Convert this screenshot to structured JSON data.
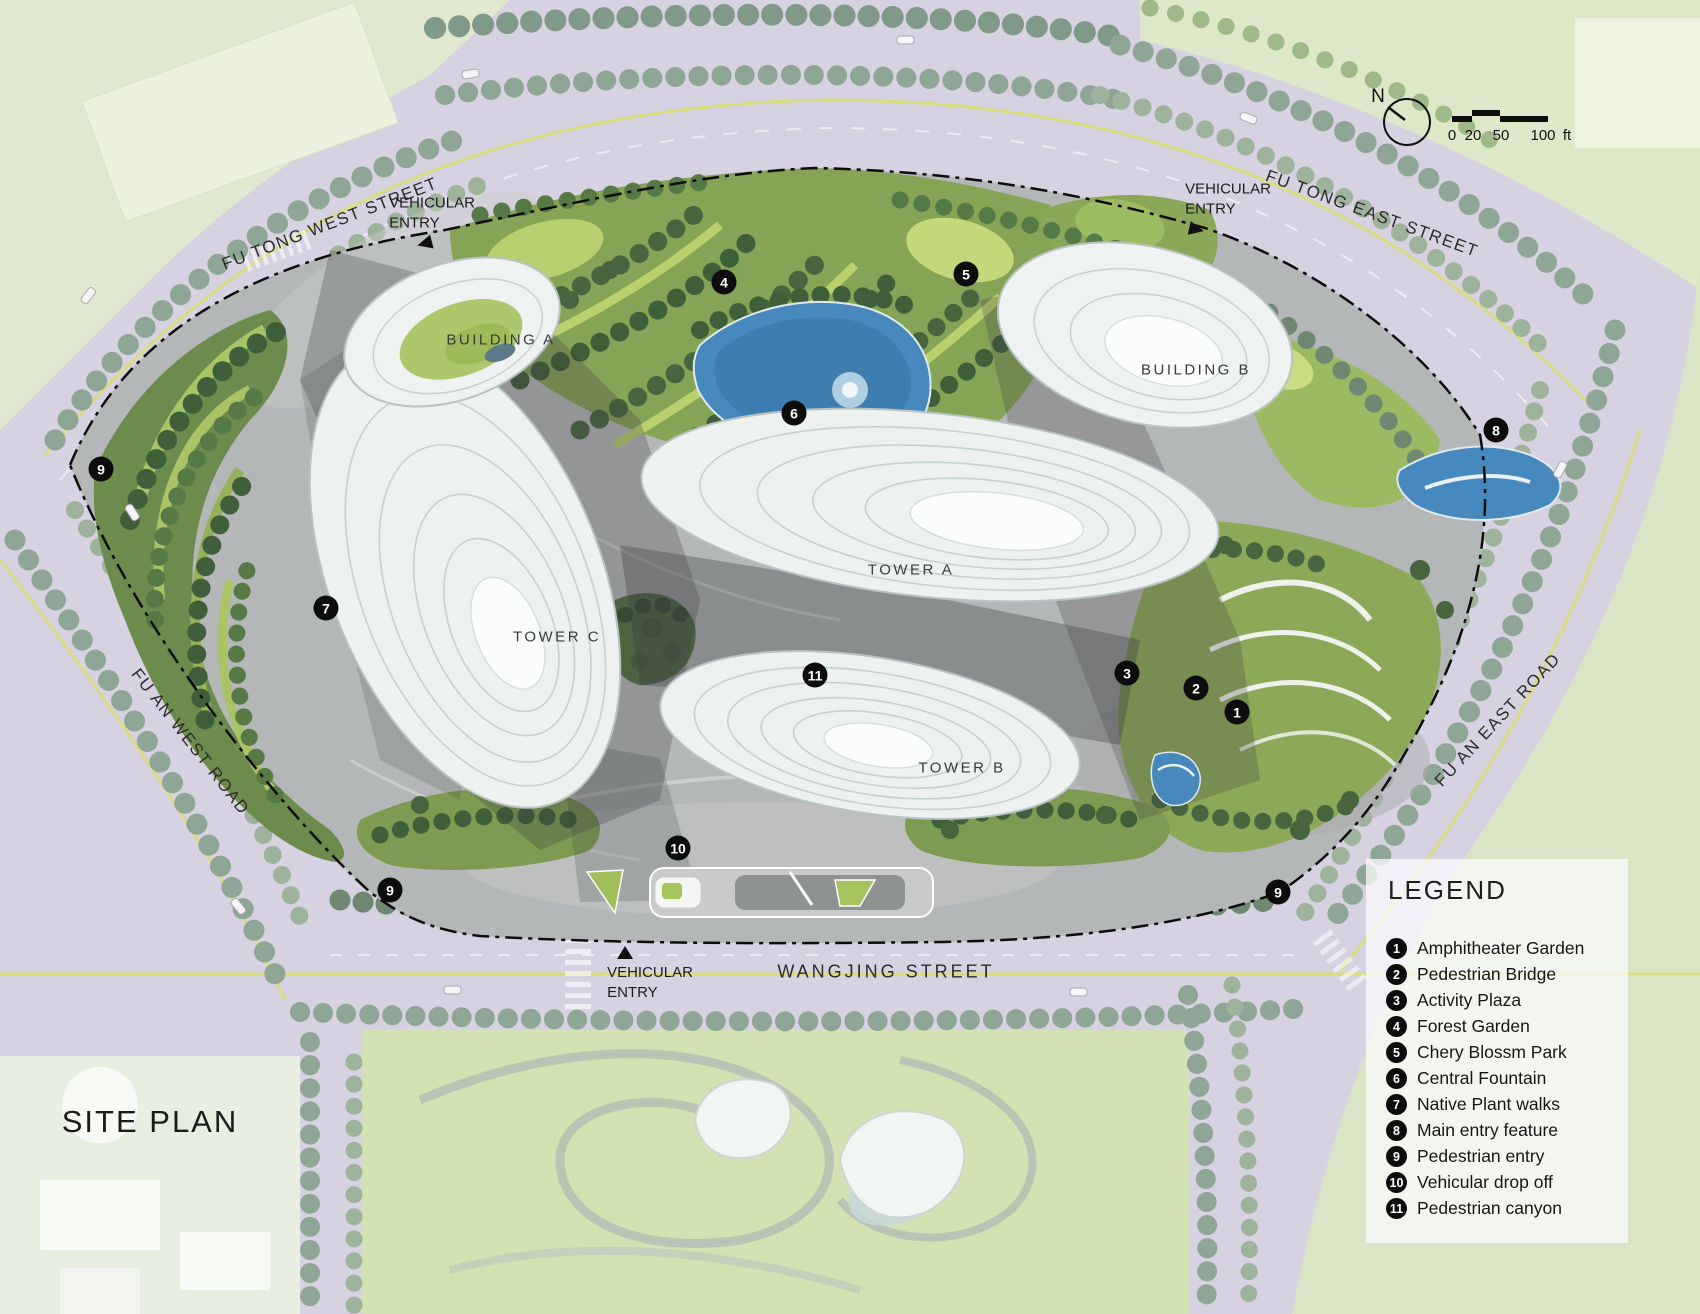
{
  "title": {
    "text": "SITE PLAN",
    "x": 150,
    "y": 1122
  },
  "compass": {
    "label": "N"
  },
  "scalebar": {
    "ticks": [
      "0",
      "20",
      "50",
      "100"
    ],
    "unit": "ft"
  },
  "legend": {
    "title": "LEGEND",
    "items": [
      {
        "num": "1",
        "label": "Amphitheater Garden"
      },
      {
        "num": "2",
        "label": "Pedestrian Bridge"
      },
      {
        "num": "3",
        "label": "Activity Plaza"
      },
      {
        "num": "4",
        "label": "Forest Garden"
      },
      {
        "num": "5",
        "label": "Chery Blossm Park"
      },
      {
        "num": "6",
        "label": "Central Fountain"
      },
      {
        "num": "7",
        "label": "Native Plant walks"
      },
      {
        "num": "8",
        "label": "Main entry feature"
      },
      {
        "num": "9",
        "label": "Pedestrian entry"
      },
      {
        "num": "10",
        "label": "Vehicular drop off"
      },
      {
        "num": "11",
        "label": "Pedestrian canyon"
      }
    ]
  },
  "streets": [
    {
      "name": "FU TONG WEST STREET",
      "x": 330,
      "y": 224
    },
    {
      "name": "FU TONG EAST STREET",
      "x": 1372,
      "y": 214
    },
    {
      "name": "FU AN WEST ROAD",
      "x": 190,
      "y": 742
    },
    {
      "name": "FU AN EAST ROAD",
      "x": 1498,
      "y": 720
    },
    {
      "name": "WANGJING  STREET",
      "x": 886,
      "y": 972
    }
  ],
  "entries": {
    "label": [
      "VEHICULAR",
      "ENTRY"
    ],
    "points": [
      {
        "x": 432,
        "y": 222
      },
      {
        "x": 1228,
        "y": 208
      },
      {
        "x": 650,
        "y": 974
      }
    ]
  },
  "buildings": [
    {
      "label": "BUILDING  A",
      "x": 501,
      "y": 340
    },
    {
      "label": "BUILDING  B",
      "x": 1196,
      "y": 370
    },
    {
      "label": "TOWER  A",
      "x": 911,
      "y": 570
    },
    {
      "label": "TOWER  B",
      "x": 962,
      "y": 768
    },
    {
      "label": "TOWER  C",
      "x": 557,
      "y": 637
    }
  ],
  "markers": [
    {
      "num": "1",
      "x": 1237,
      "y": 712
    },
    {
      "num": "2",
      "x": 1196,
      "y": 688
    },
    {
      "num": "3",
      "x": 1127,
      "y": 673
    },
    {
      "num": "4",
      "x": 724,
      "y": 282
    },
    {
      "num": "5",
      "x": 966,
      "y": 274
    },
    {
      "num": "6",
      "x": 794,
      "y": 413
    },
    {
      "num": "7",
      "x": 326,
      "y": 608
    },
    {
      "num": "8",
      "x": 1496,
      "y": 430
    },
    {
      "num": "9",
      "x": 101,
      "y": 469
    },
    {
      "num": "9",
      "x": 390,
      "y": 890
    },
    {
      "num": "9",
      "x": 1278,
      "y": 892
    },
    {
      "num": "10",
      "x": 678,
      "y": 848
    },
    {
      "num": "11",
      "x": 815,
      "y": 675
    }
  ]
}
